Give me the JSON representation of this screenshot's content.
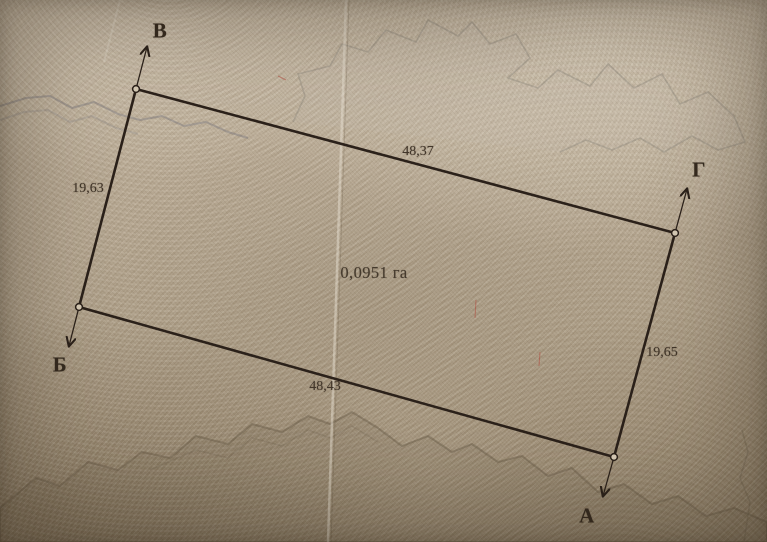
{
  "document": {
    "kind_label": "land parcel survey plan photo",
    "area_label": "0,0951 га",
    "area_value_ha": 0.0951
  },
  "plan": {
    "corners": [
      {
        "key": "v",
        "label": "В"
      },
      {
        "key": "g",
        "label": "Г"
      },
      {
        "key": "a",
        "label": "А"
      },
      {
        "key": "b",
        "label": "Б"
      }
    ],
    "sides": [
      {
        "name": "side-v-g",
        "from": "В",
        "to": "Г",
        "length_label": "48,37",
        "length_m": 48.37
      },
      {
        "name": "side-g-a",
        "from": "Г",
        "to": "А",
        "length_label": "19,65",
        "length_m": 19.65
      },
      {
        "name": "side-b-a",
        "from": "Б",
        "to": "А",
        "length_label": "48,43",
        "length_m": 48.43
      },
      {
        "name": "side-v-b",
        "from": "В",
        "to": "Б",
        "length_label": "19,63",
        "length_m": 19.63
      }
    ]
  },
  "colors": {
    "ink": "#2b211a",
    "paper_base": "#b2a38c",
    "paper_light": "#cdbfa9",
    "paper_dark": "#9e8e75",
    "pattern_grey": "#8e887d"
  }
}
